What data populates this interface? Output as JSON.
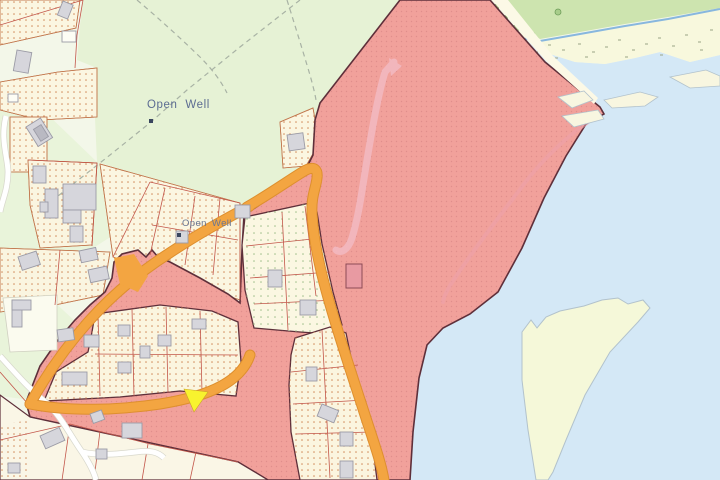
{
  "map": {
    "description": "Cadastral planning map with flood/constraint zone, coastal water, roads and parcels",
    "labels": {
      "open_well_1": "Open Well",
      "open_well_2": "Open Well"
    },
    "markers": [
      {
        "name": "open-well-marker-1",
        "x": 149,
        "y": 119
      },
      {
        "name": "open-well-marker-2",
        "x": 177,
        "y": 233
      }
    ],
    "colors": {
      "water": "#d4e8f6",
      "land": "#f3f7e9",
      "field_green": "#e6f2d5",
      "west_green": "#e9f4da",
      "flood_zone_fill": "#f1a19b",
      "flood_zone_border": "#5e2f3a",
      "road_orange": "#f3a541",
      "road_casing": "#de8f2e",
      "highlight_yellow": "#f8f32e",
      "parcel_cream": "#fbf6e1",
      "building_gray": "#d6d6dc",
      "label_blue": "#5c6c92",
      "coastal_strip": "#f8f8dd",
      "tree_band_green": "#cde4af",
      "sandbank": "#f5f8d9",
      "track_pink": "#f2b6bc",
      "parcel_line": "#c2564a"
    }
  }
}
